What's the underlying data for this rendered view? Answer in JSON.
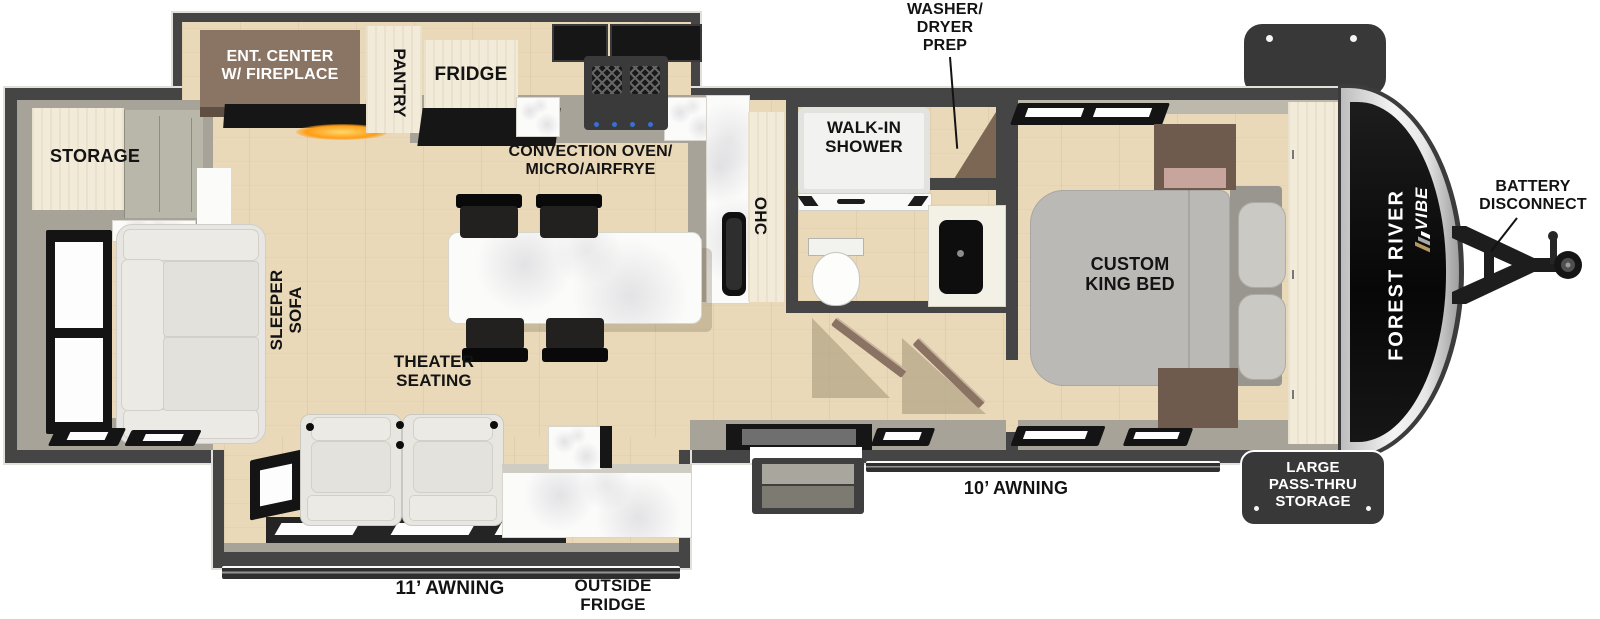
{
  "brand": {
    "maker": "FOREST RIVER",
    "model": "VIBE"
  },
  "exterior": {
    "battery_disconnect": "BATTERY\nDISCONNECT",
    "pass_thru_storage": "LARGE\nPASS-THRU\nSTORAGE",
    "awning_front": "10’ AWNING",
    "awning_rear": "11’ AWNING",
    "outside_fridge": "OUTSIDE\nFRIDGE"
  },
  "kitchen": {
    "pantry": "PANTRY",
    "fridge": "FRIDGE",
    "convection": "CONVECTION OVEN/\nMICRO/AIRFRYE",
    "sink": "SINK",
    "ohc": "OHC"
  },
  "living": {
    "storage": "STORAGE",
    "ent_center": "ENT. CENTER\nW/ FIREPLACE",
    "sleeper_sofa": "SLEEPER\nSOFA",
    "theater_seating": "THEATER\nSEATING"
  },
  "bath": {
    "walk_in_shower": "WALK-IN\nSHOWER",
    "washer_dryer_prep": "WASHER/\nDRYER\nPREP"
  },
  "bedroom": {
    "custom_king_bed": "CUSTOM\nKING BED"
  },
  "colors": {
    "wall": "#454545",
    "floor_wood": "#ead9b9",
    "interior_wall": "#a8a399",
    "cabinet_cream": "#f2ebd9",
    "cabinet_brown": "#8a7565",
    "flame_accent": "#ff9d16",
    "storage_box": "#383838",
    "label_text": "#131313"
  }
}
